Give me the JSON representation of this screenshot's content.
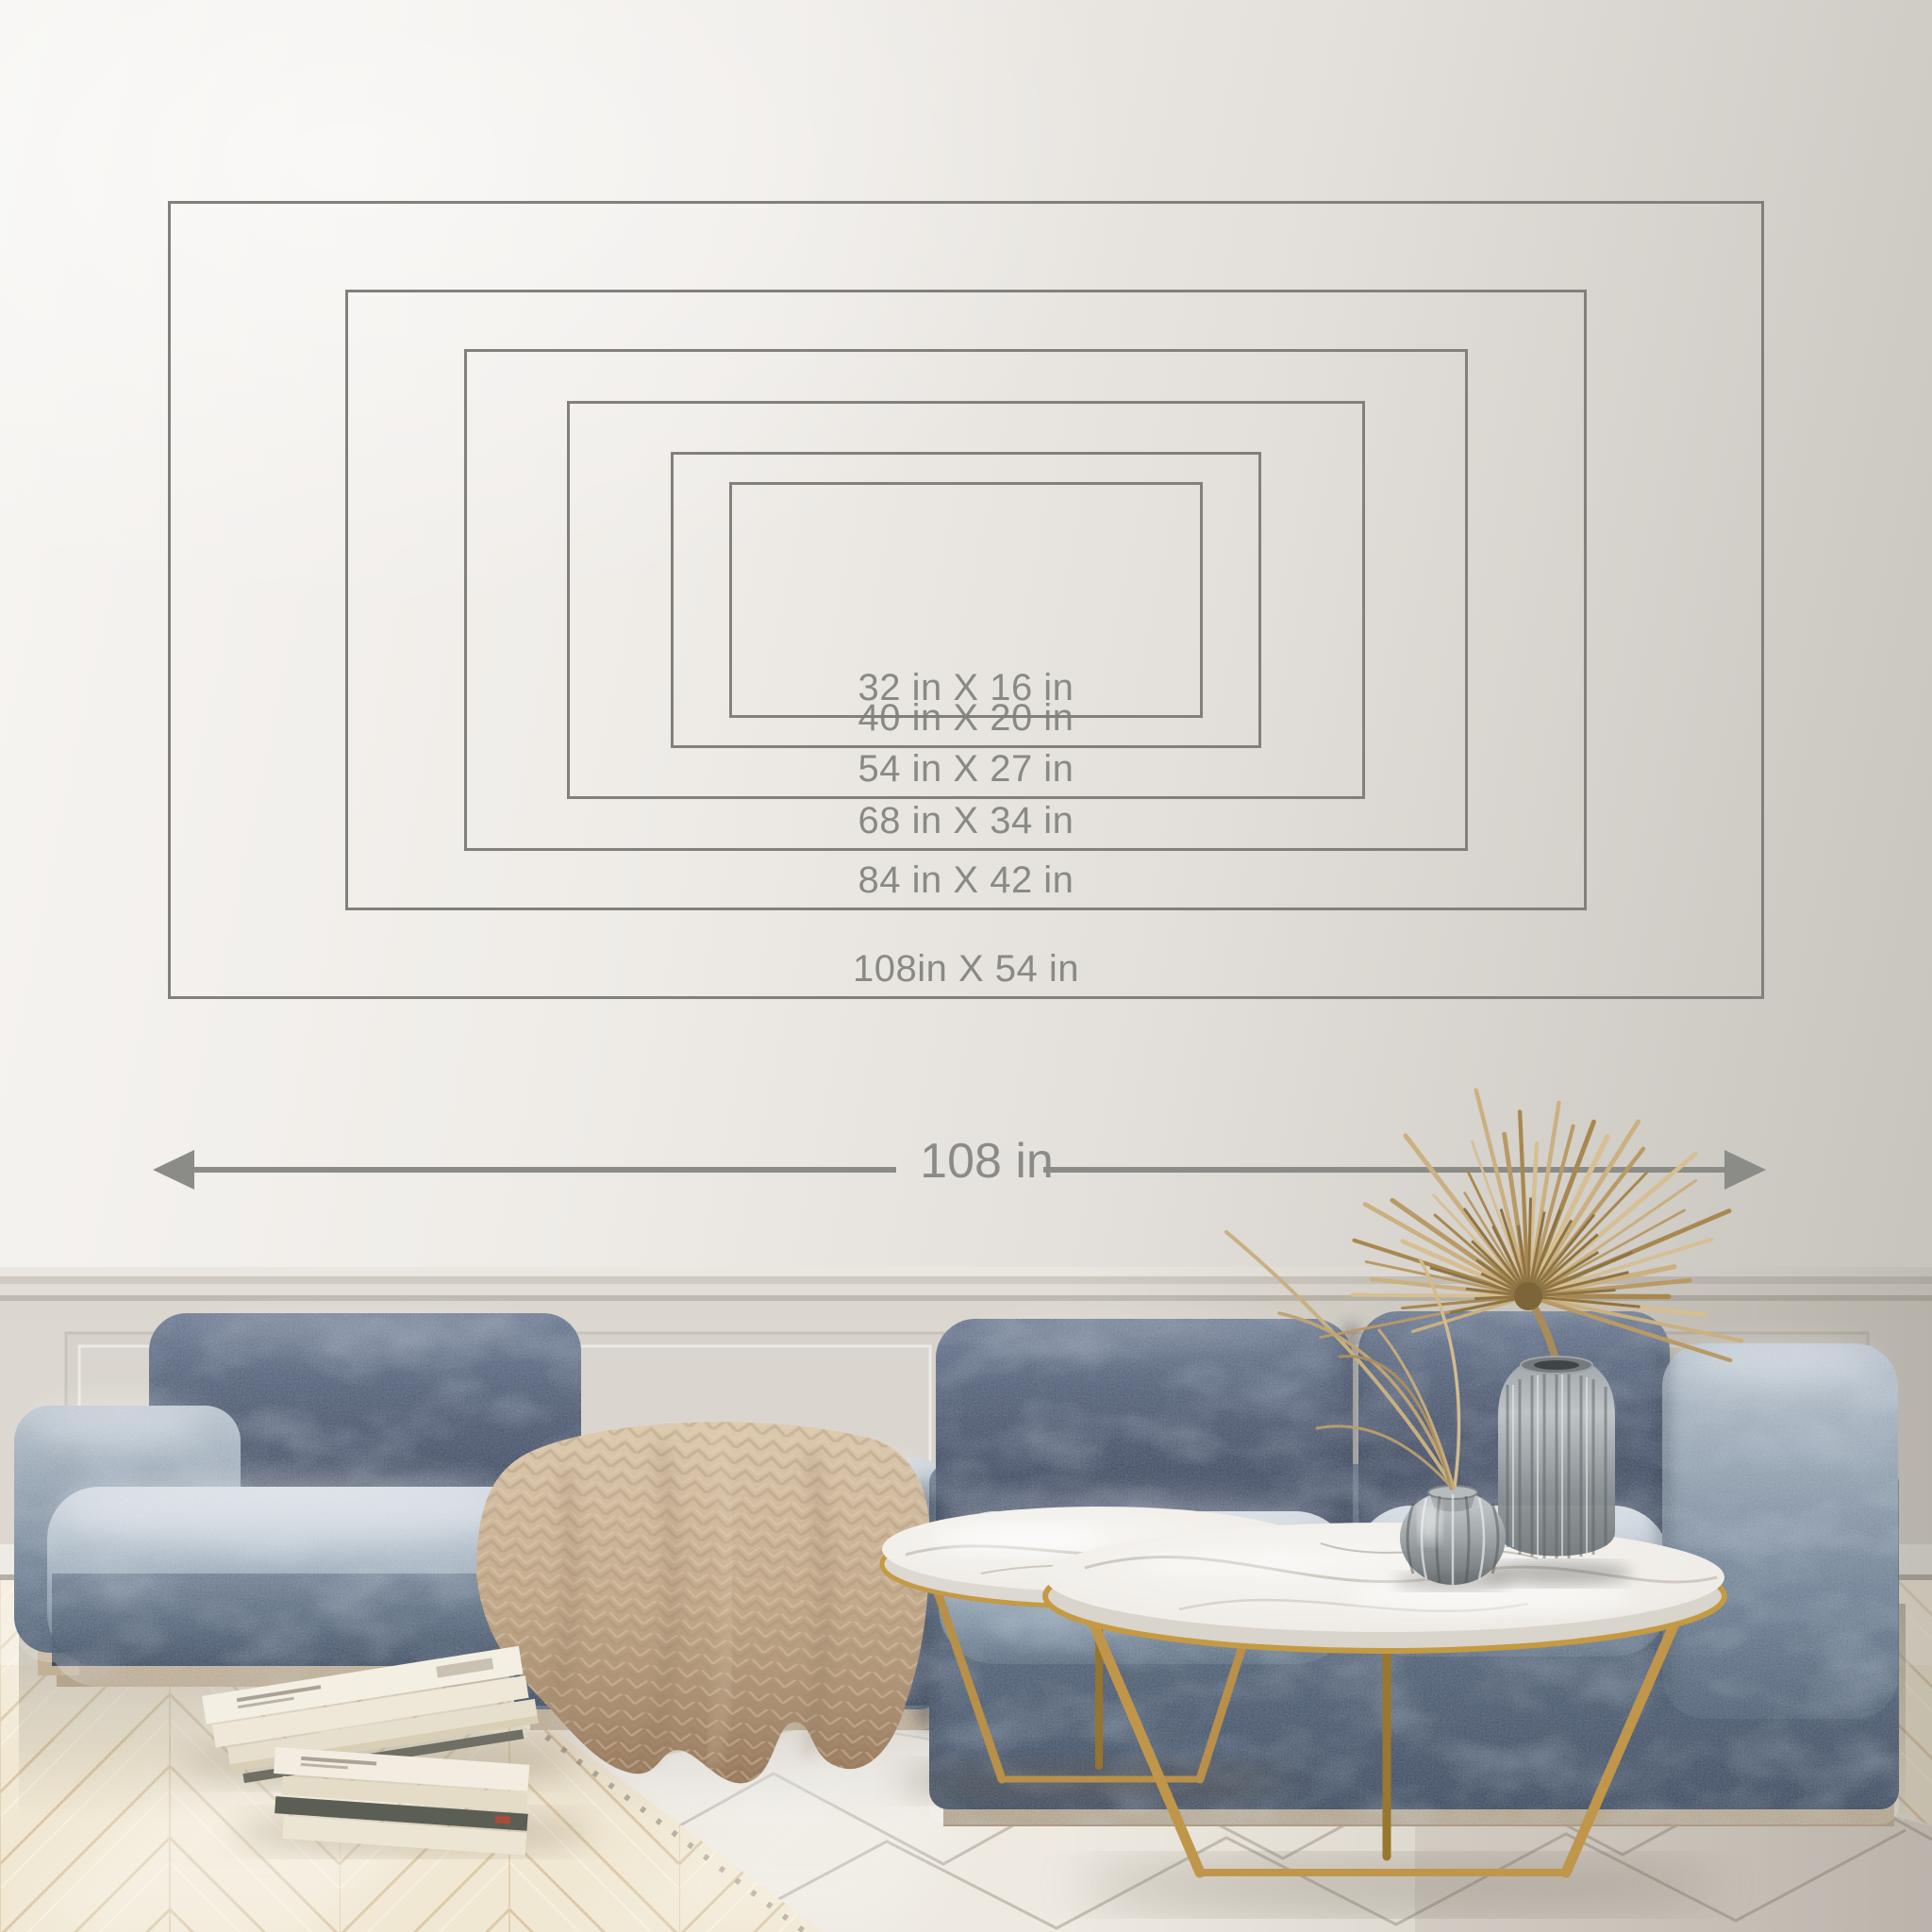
{
  "size_guide": {
    "sizes": [
      {
        "width_in": 32,
        "height_in": 16,
        "label": "32 in X 16 in"
      },
      {
        "width_in": 40,
        "height_in": 20,
        "label": "40 in X 20 in"
      },
      {
        "width_in": 54,
        "height_in": 27,
        "label": "54 in X 27 in"
      },
      {
        "width_in": 68,
        "height_in": 34,
        "label": "68 in X 34 in"
      },
      {
        "width_in": 84,
        "height_in": 42,
        "label": "84 in X 42 in"
      },
      {
        "width_in": 108,
        "height_in": 54,
        "label": "108in X 54 in"
      }
    ],
    "width_dimension": {
      "label": "108 in",
      "value_in": 108
    }
  },
  "colors": {
    "diagram_line": "#81807b",
    "diagram_text": "#8a8a85",
    "dimension_arrow": "#8b8b88",
    "wall_light": "#f6f4f1",
    "wall_dark": "#c5c2bc",
    "sofa_velvet_dark": "#2e3a50",
    "sofa_velvet_light": "#aab8c6",
    "throw_blanket": "#c6ae93",
    "table_gold": "#c49a43",
    "marble": "#f2efeb",
    "rug": "#eeeae2",
    "floor_wood": "#f1e8d4",
    "dried_palm": "#c0a46f",
    "glass_vase": "#8f9699"
  }
}
